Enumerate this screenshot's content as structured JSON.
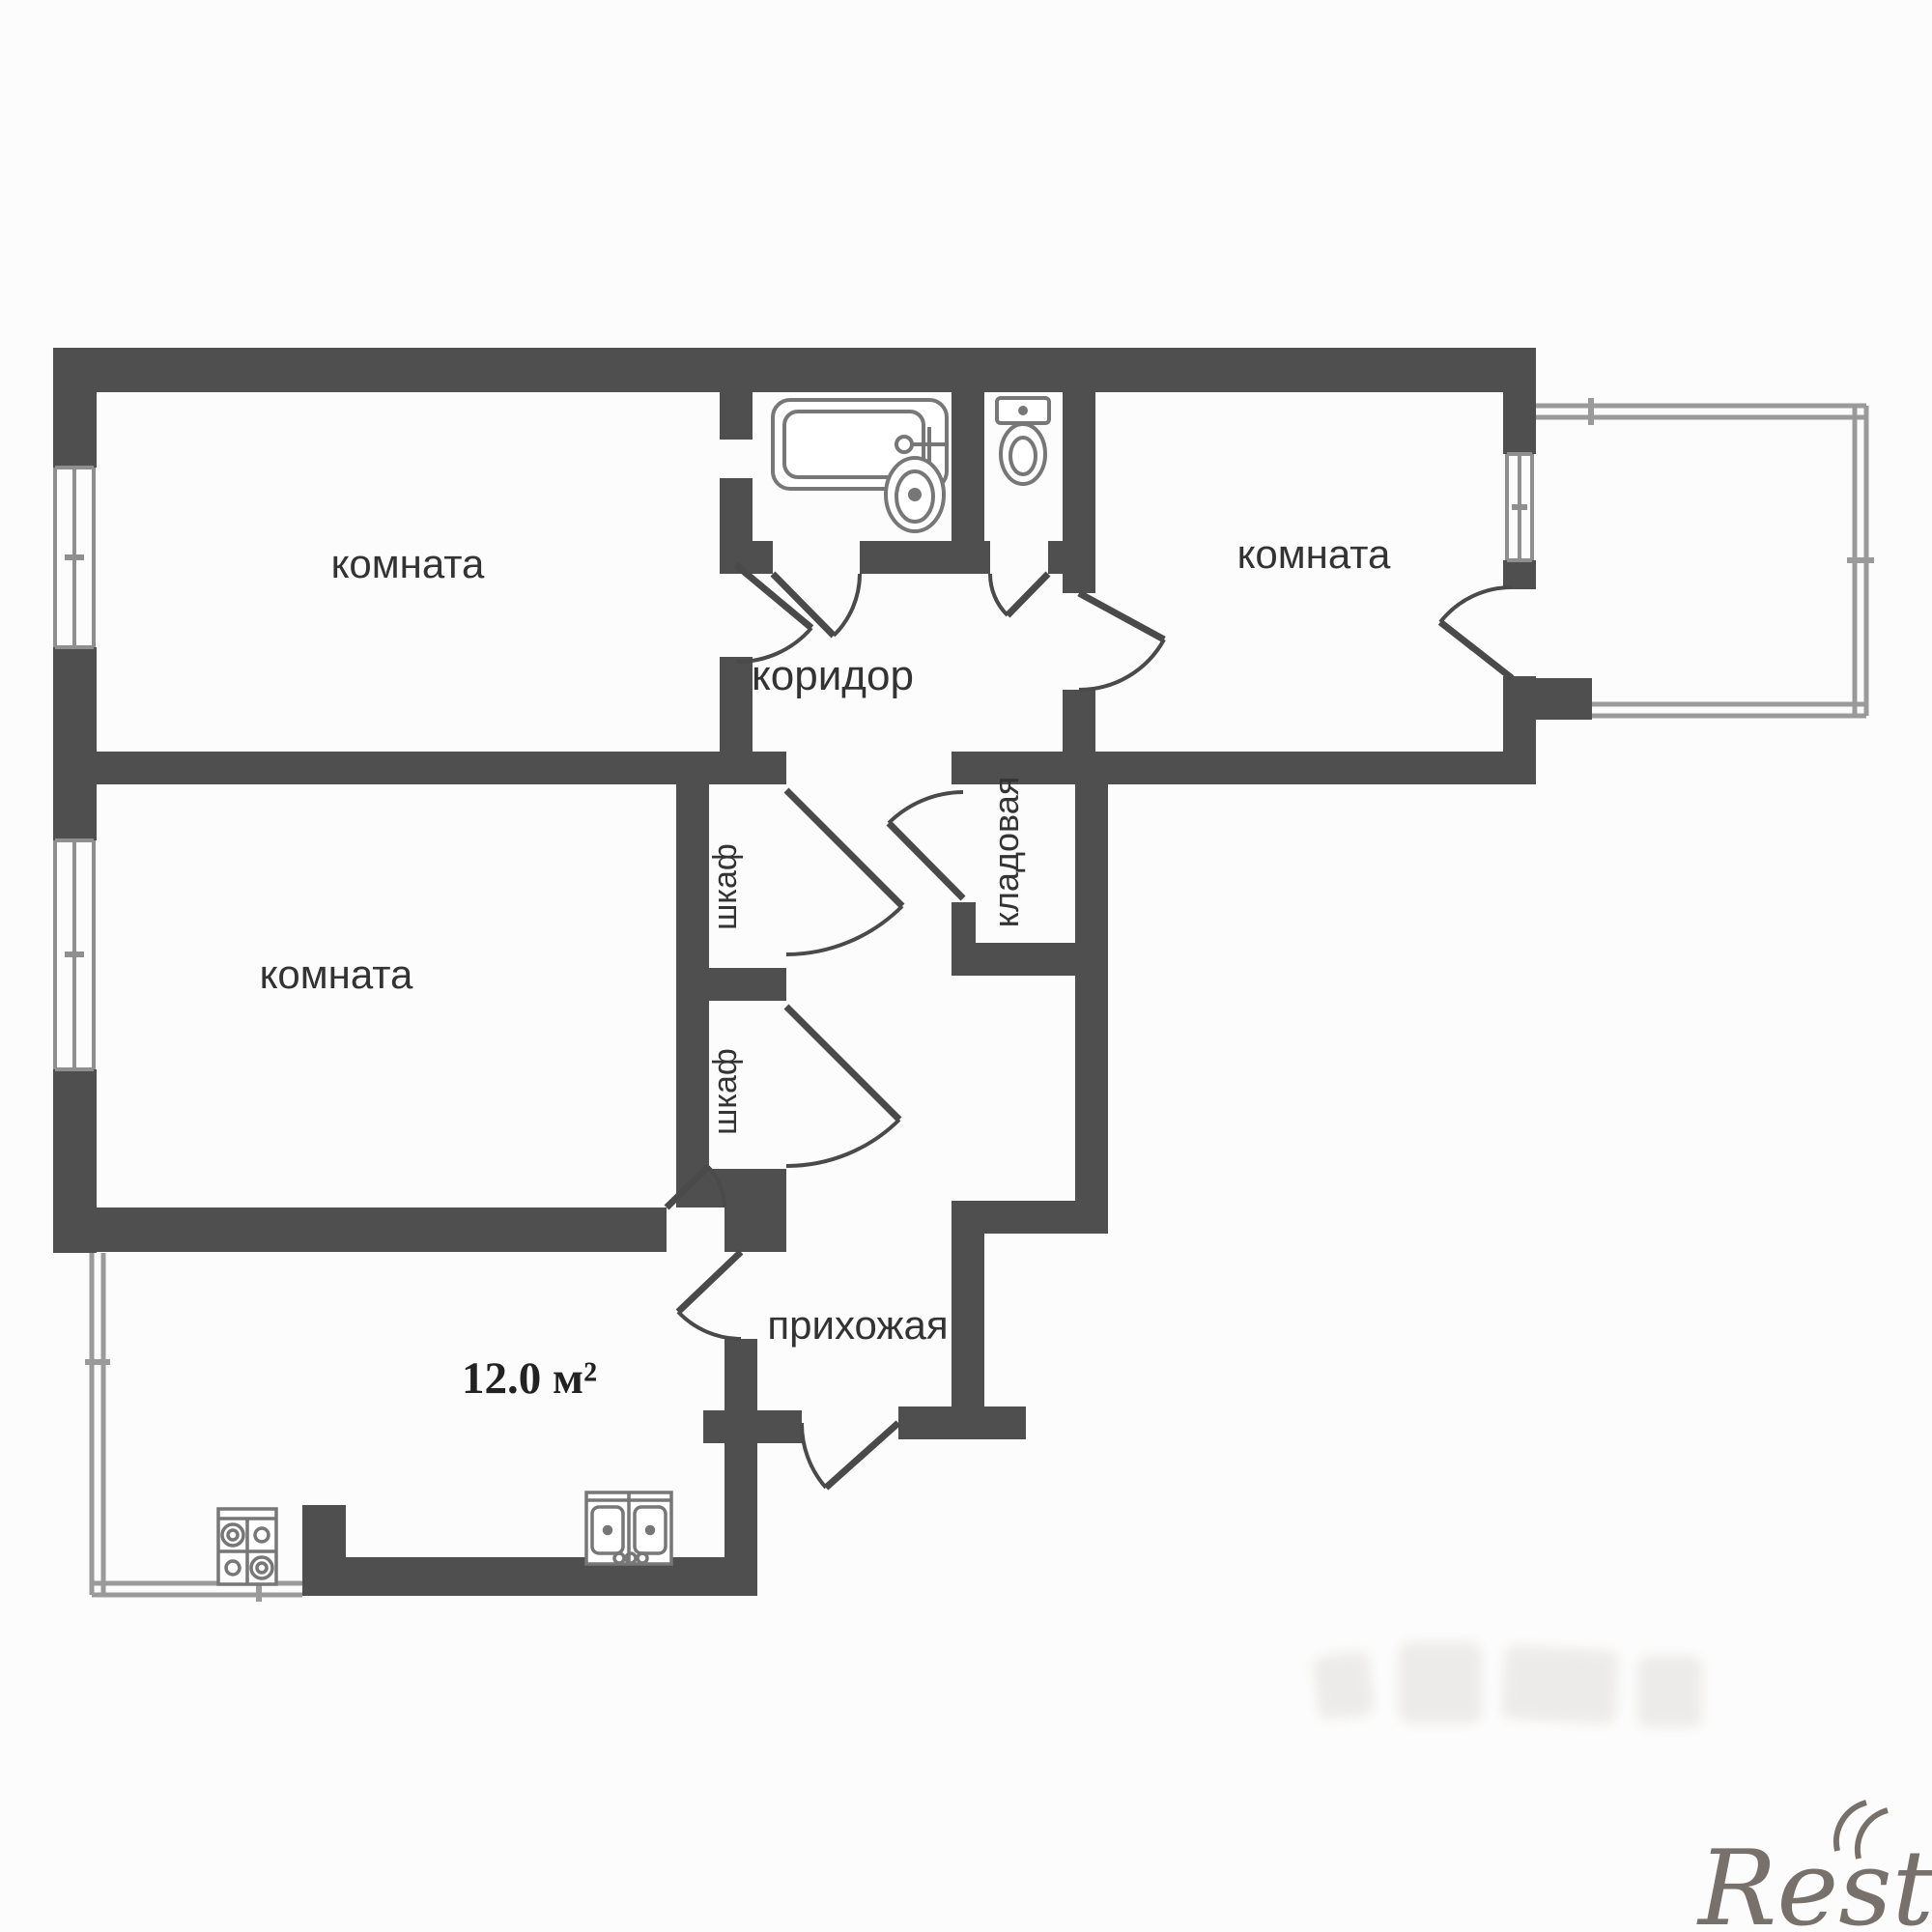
{
  "plan": {
    "rooms": [
      {
        "id": "room-top-left",
        "label": "комната"
      },
      {
        "id": "room-top-right",
        "label": "комната"
      },
      {
        "id": "room-middle-left",
        "label": "комната"
      },
      {
        "id": "corridor",
        "label": "коридор"
      },
      {
        "id": "closet-upper",
        "label": "шкаф"
      },
      {
        "id": "closet-lower",
        "label": "шкаф"
      },
      {
        "id": "pantry",
        "label": "кладовая"
      },
      {
        "id": "hallway",
        "label": "прихожая"
      },
      {
        "id": "kitchen",
        "label": "12.0 м²"
      }
    ],
    "fixtures": [
      "bathtub-icon",
      "bath-sink-icon",
      "toilet-icon",
      "stove-icon",
      "kitchen-sink-icon"
    ],
    "window_count": 4,
    "colors": {
      "wall": "#4f4f4f",
      "thin_line": "#8f8f8f",
      "door_line": "#4a4a4a",
      "label": "#333333",
      "background": "#fcfcfc",
      "watermark": "#77706b"
    }
  },
  "watermark": {
    "text": "Restate"
  }
}
